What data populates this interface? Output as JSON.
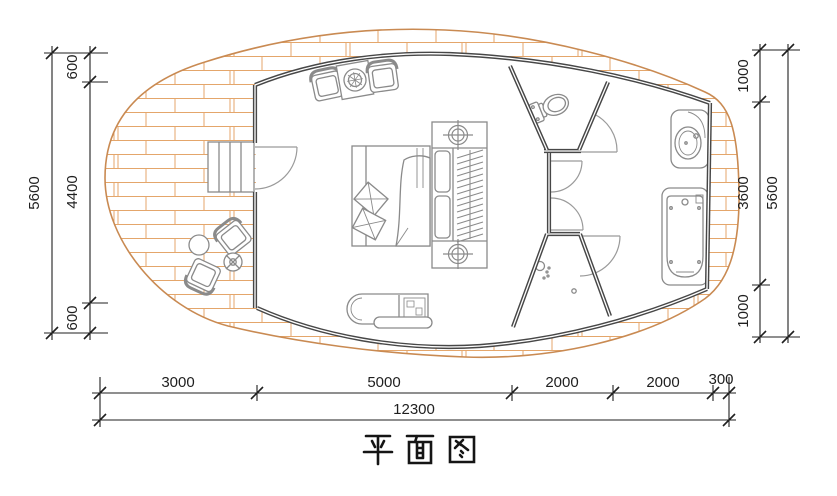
{
  "title": "平面图",
  "colors": {
    "background": "#ffffff",
    "deck_outline": "#c98a52",
    "deck_plank": "#e4a66b",
    "wall": "#474747",
    "furniture": "#8a8a8a",
    "dim": "#1f1f1f"
  },
  "dimensions": {
    "left": {
      "segments": [
        {
          "label": "600"
        },
        {
          "label": "4400"
        },
        {
          "label": "600"
        }
      ],
      "total": {
        "label": "5600"
      }
    },
    "right": {
      "segments": [
        {
          "label": "1000"
        },
        {
          "label": "3600"
        },
        {
          "label": "1000"
        }
      ],
      "total": {
        "label": "5600"
      }
    },
    "bottom": {
      "segments": [
        {
          "label": "3000"
        },
        {
          "label": "5000"
        },
        {
          "label": "2000"
        },
        {
          "label": "2000"
        },
        {
          "label": "300"
        }
      ],
      "total": {
        "label": "12300"
      }
    }
  }
}
